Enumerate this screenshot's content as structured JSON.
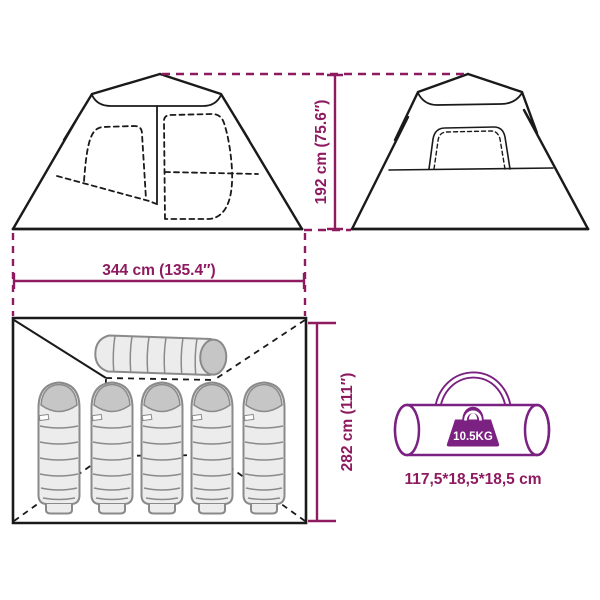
{
  "colors": {
    "dimension": "#8E1A60",
    "bag_accent": "#7B2182",
    "outline": "#1a1a1a",
    "sleeping_bag_fill": "#ECECEC",
    "sleeping_bag_stroke": "#8A8A8A",
    "sleeping_bag_hood": "#C6C6C6",
    "white": "#ffffff",
    "background": "#ffffff"
  },
  "dimensions": {
    "height_label": "192 cm (75.6″)",
    "width_label": "344 cm (135.4″)",
    "depth_label": "282 cm (111″)"
  },
  "carry_bag": {
    "weight_label": "10.5KG",
    "size_label": "117,5*18,5*18,5 cm"
  },
  "floor_plan": {
    "sleeping_bag_count": 5,
    "rolled_mat_count": 1
  }
}
